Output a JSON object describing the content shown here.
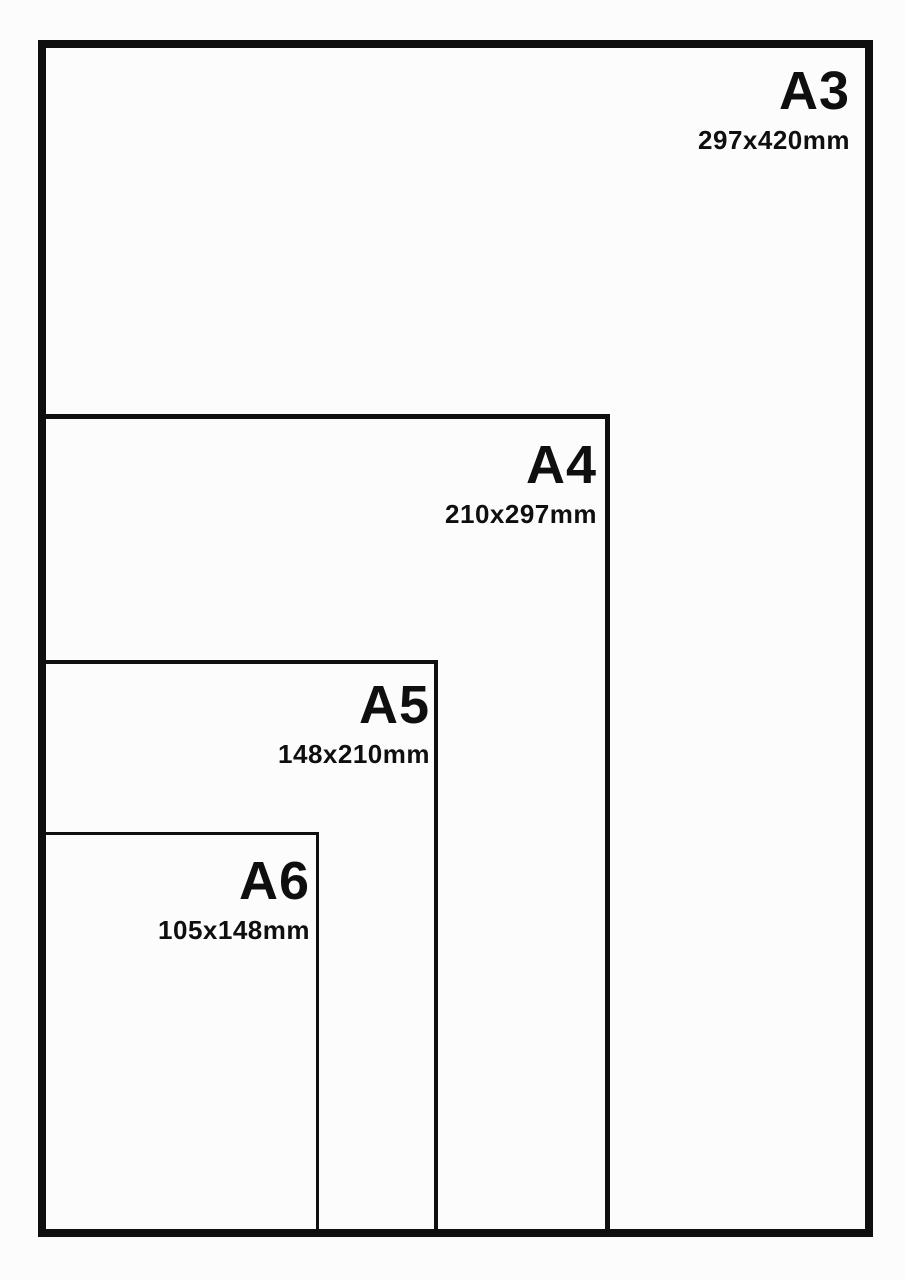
{
  "diagram": {
    "background": "#fcfcfc",
    "line_color": "#0f0f0f",
    "sizes": [
      {
        "label": "A3",
        "dimensions": "297x420mm"
      },
      {
        "label": "A4",
        "dimensions": "210x297mm"
      },
      {
        "label": "A5",
        "dimensions": "148x210mm"
      },
      {
        "label": "A6",
        "dimensions": "105x148mm"
      }
    ]
  }
}
